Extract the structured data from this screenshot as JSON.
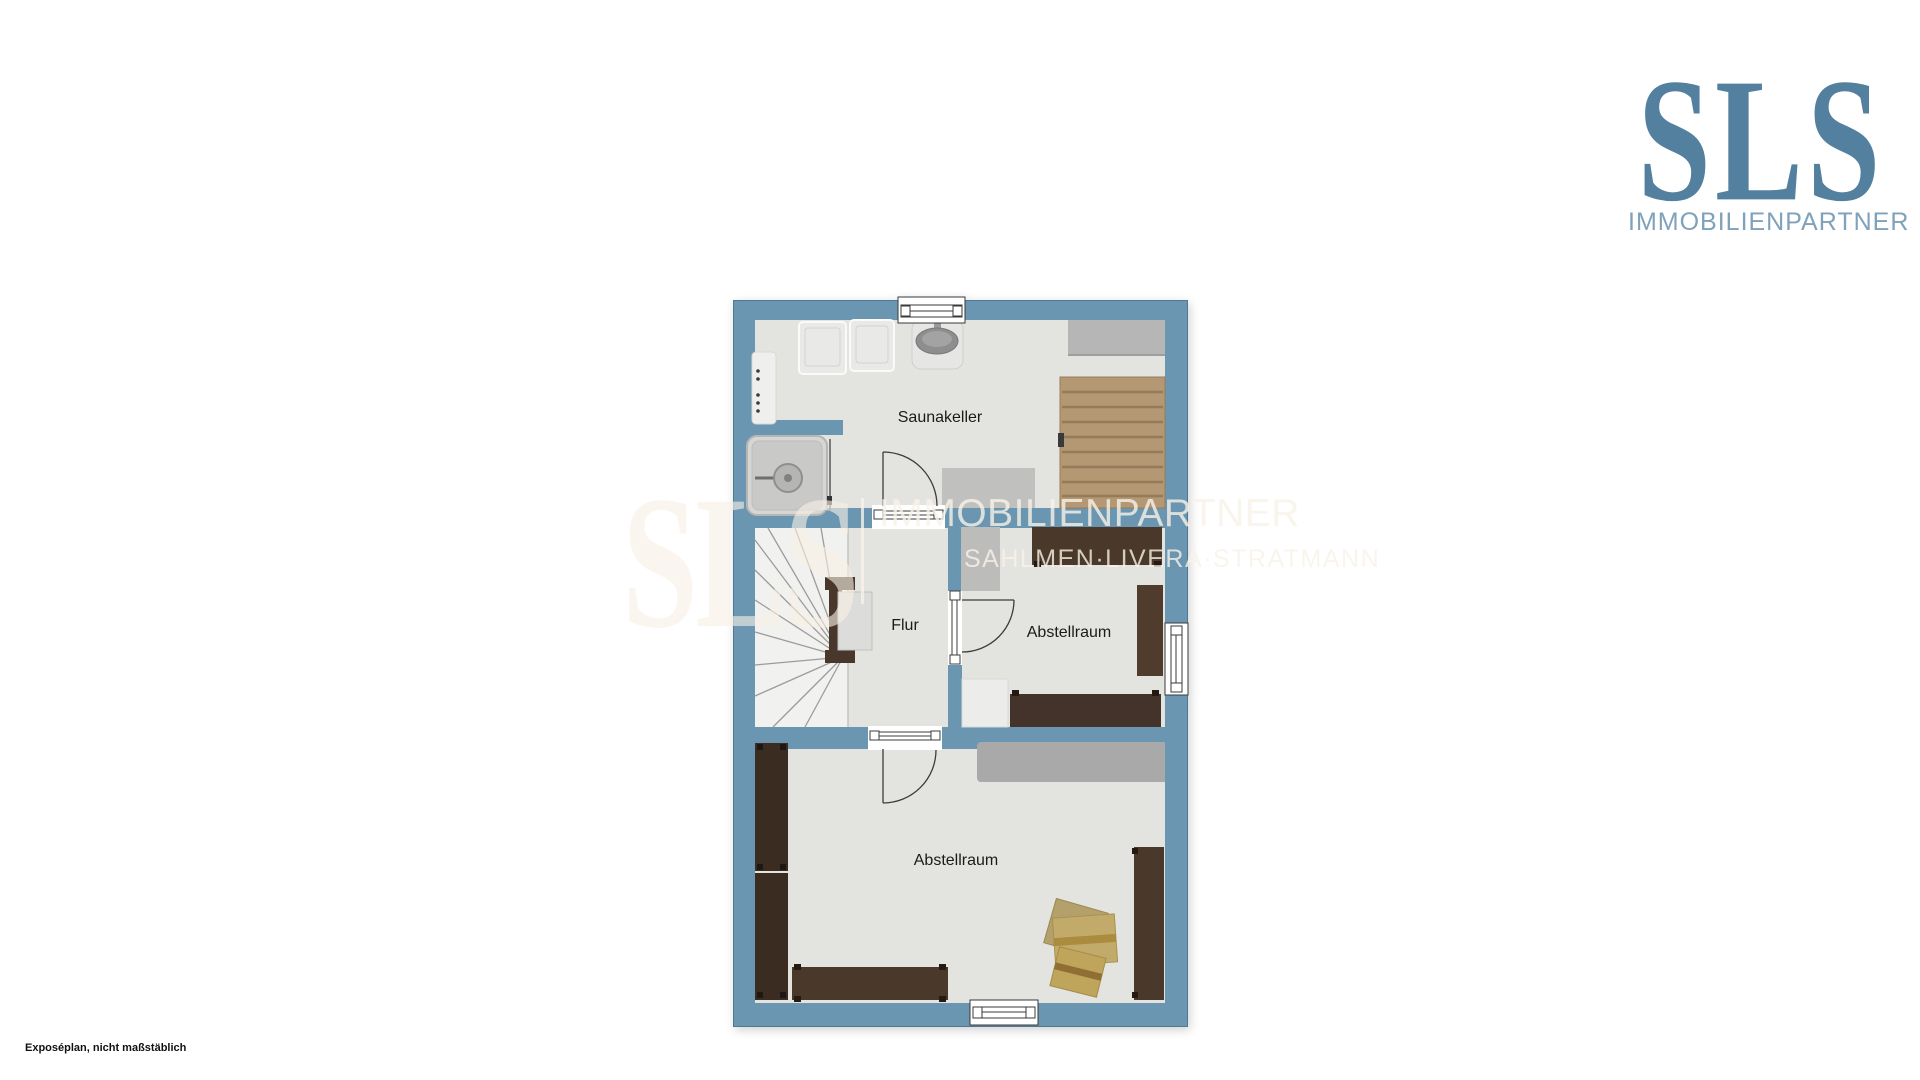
{
  "brand": {
    "name": "SLS",
    "tagline": "IMMOBILIENPARTNER",
    "logo_color": "#54809f",
    "tagline_color": "#7fa2ba"
  },
  "watermark": {
    "name": "SLS",
    "line1": "IMMOBILIENPARTNER",
    "line2": "SAHLMEN·LIVERA·STRATMANN"
  },
  "floorplan": {
    "wall_color": "#6b96b1",
    "floor_color": "#e3e3e0",
    "rooms": [
      {
        "name": "Saunakeller"
      },
      {
        "name": "Flur"
      },
      {
        "name": "Abstellraum"
      },
      {
        "name": "Abstellraum"
      }
    ]
  },
  "footnote": "Exposéplan, nicht maßstäblich"
}
